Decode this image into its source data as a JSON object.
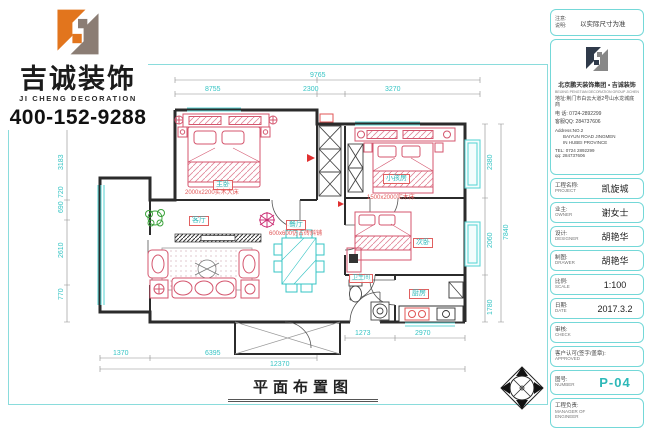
{
  "brand": {
    "name_cn": "吉诚装饰",
    "name_en": "JI CHENG DECORATION",
    "phone": "400-152-9288"
  },
  "title_block": {
    "note": {
      "label1": "注意:",
      "label2": "说明:",
      "text": "以实际尺寸为准"
    },
    "company": {
      "group_cn": "北京鹏天装饰集团 • 吉诚装饰",
      "group_en": "BEIJING PENGTIAN DECORATION GROUP JICHENG DECORATION",
      "address_cn": "地址:荆门市白云大道2号山水龙城底商",
      "phone_cn": "电 话: 0724-2892299",
      "qq_cn": "客服QQ: 284737606",
      "address_en1": "Address:NO.2",
      "address_en2": "BAIYUN ROAD JINGMEN",
      "address_en3": "IN HUBEI PROVINCE",
      "tel_en": "TEL: 0724 2892299",
      "qq_en": "qq: 284737606"
    },
    "fields": [
      {
        "zh": "工程名称:",
        "en": "PROJECT",
        "value": "凯旋城"
      },
      {
        "zh": "业主:",
        "en": "OWNER",
        "value": "谢女士"
      },
      {
        "zh": "设计:",
        "en": "DESIGNER",
        "value": "胡艳华"
      },
      {
        "zh": "制图:",
        "en": "DRAWER",
        "value": "胡艳华"
      },
      {
        "zh": "比例:",
        "en": "SCALE",
        "value": "1:100"
      },
      {
        "zh": "日期:",
        "en": "DATE",
        "value": "2017.3.2"
      },
      {
        "zh": "审核:",
        "en": "CHECK",
        "value": ""
      },
      {
        "zh": "客户认可(签字/盖章):",
        "en": "APPROVED",
        "value": ""
      }
    ],
    "number": {
      "zh": "图号:",
      "en": "NUMBER",
      "value": "P-04"
    },
    "manager": {
      "zh": "工程负责:",
      "en1": "MANAGER OF",
      "en2": "ENGINEER"
    }
  },
  "plan": {
    "title": "平面布置图",
    "rooms": {
      "master": "主卧",
      "kids": "小孩房",
      "second": "次卧",
      "living": "客厅",
      "dining": "餐厅",
      "kitchen": "厨房",
      "bath": "卫生间"
    },
    "annotations": {
      "master_bed": "2000x2200实木大床",
      "kids_bed": "1500x2000实木床",
      "dining_floor": "600x600仿古砖斜铺"
    },
    "dims": {
      "top_total": "9765",
      "top_a": "8755",
      "top_b": "2300",
      "top_c": "3270",
      "bottom_a": "1370",
      "bottom_b": "6395",
      "bottom_c": "1273",
      "bottom_d": "2970",
      "bottom_total": "12370",
      "left_a": "3183",
      "left_b": "720",
      "left_c": "690",
      "left_d": "2610",
      "left_e": "770",
      "right_a": "2380",
      "right_b": "2060",
      "right_c": "1780",
      "right_d": "7840"
    }
  },
  "colors": {
    "accent_cyan": "#35c4c4",
    "furniture_pink": "#d4566e",
    "annotation_red": "#e05555",
    "logo_orange": "#e2751d",
    "logo_gray": "#8b7d74"
  }
}
